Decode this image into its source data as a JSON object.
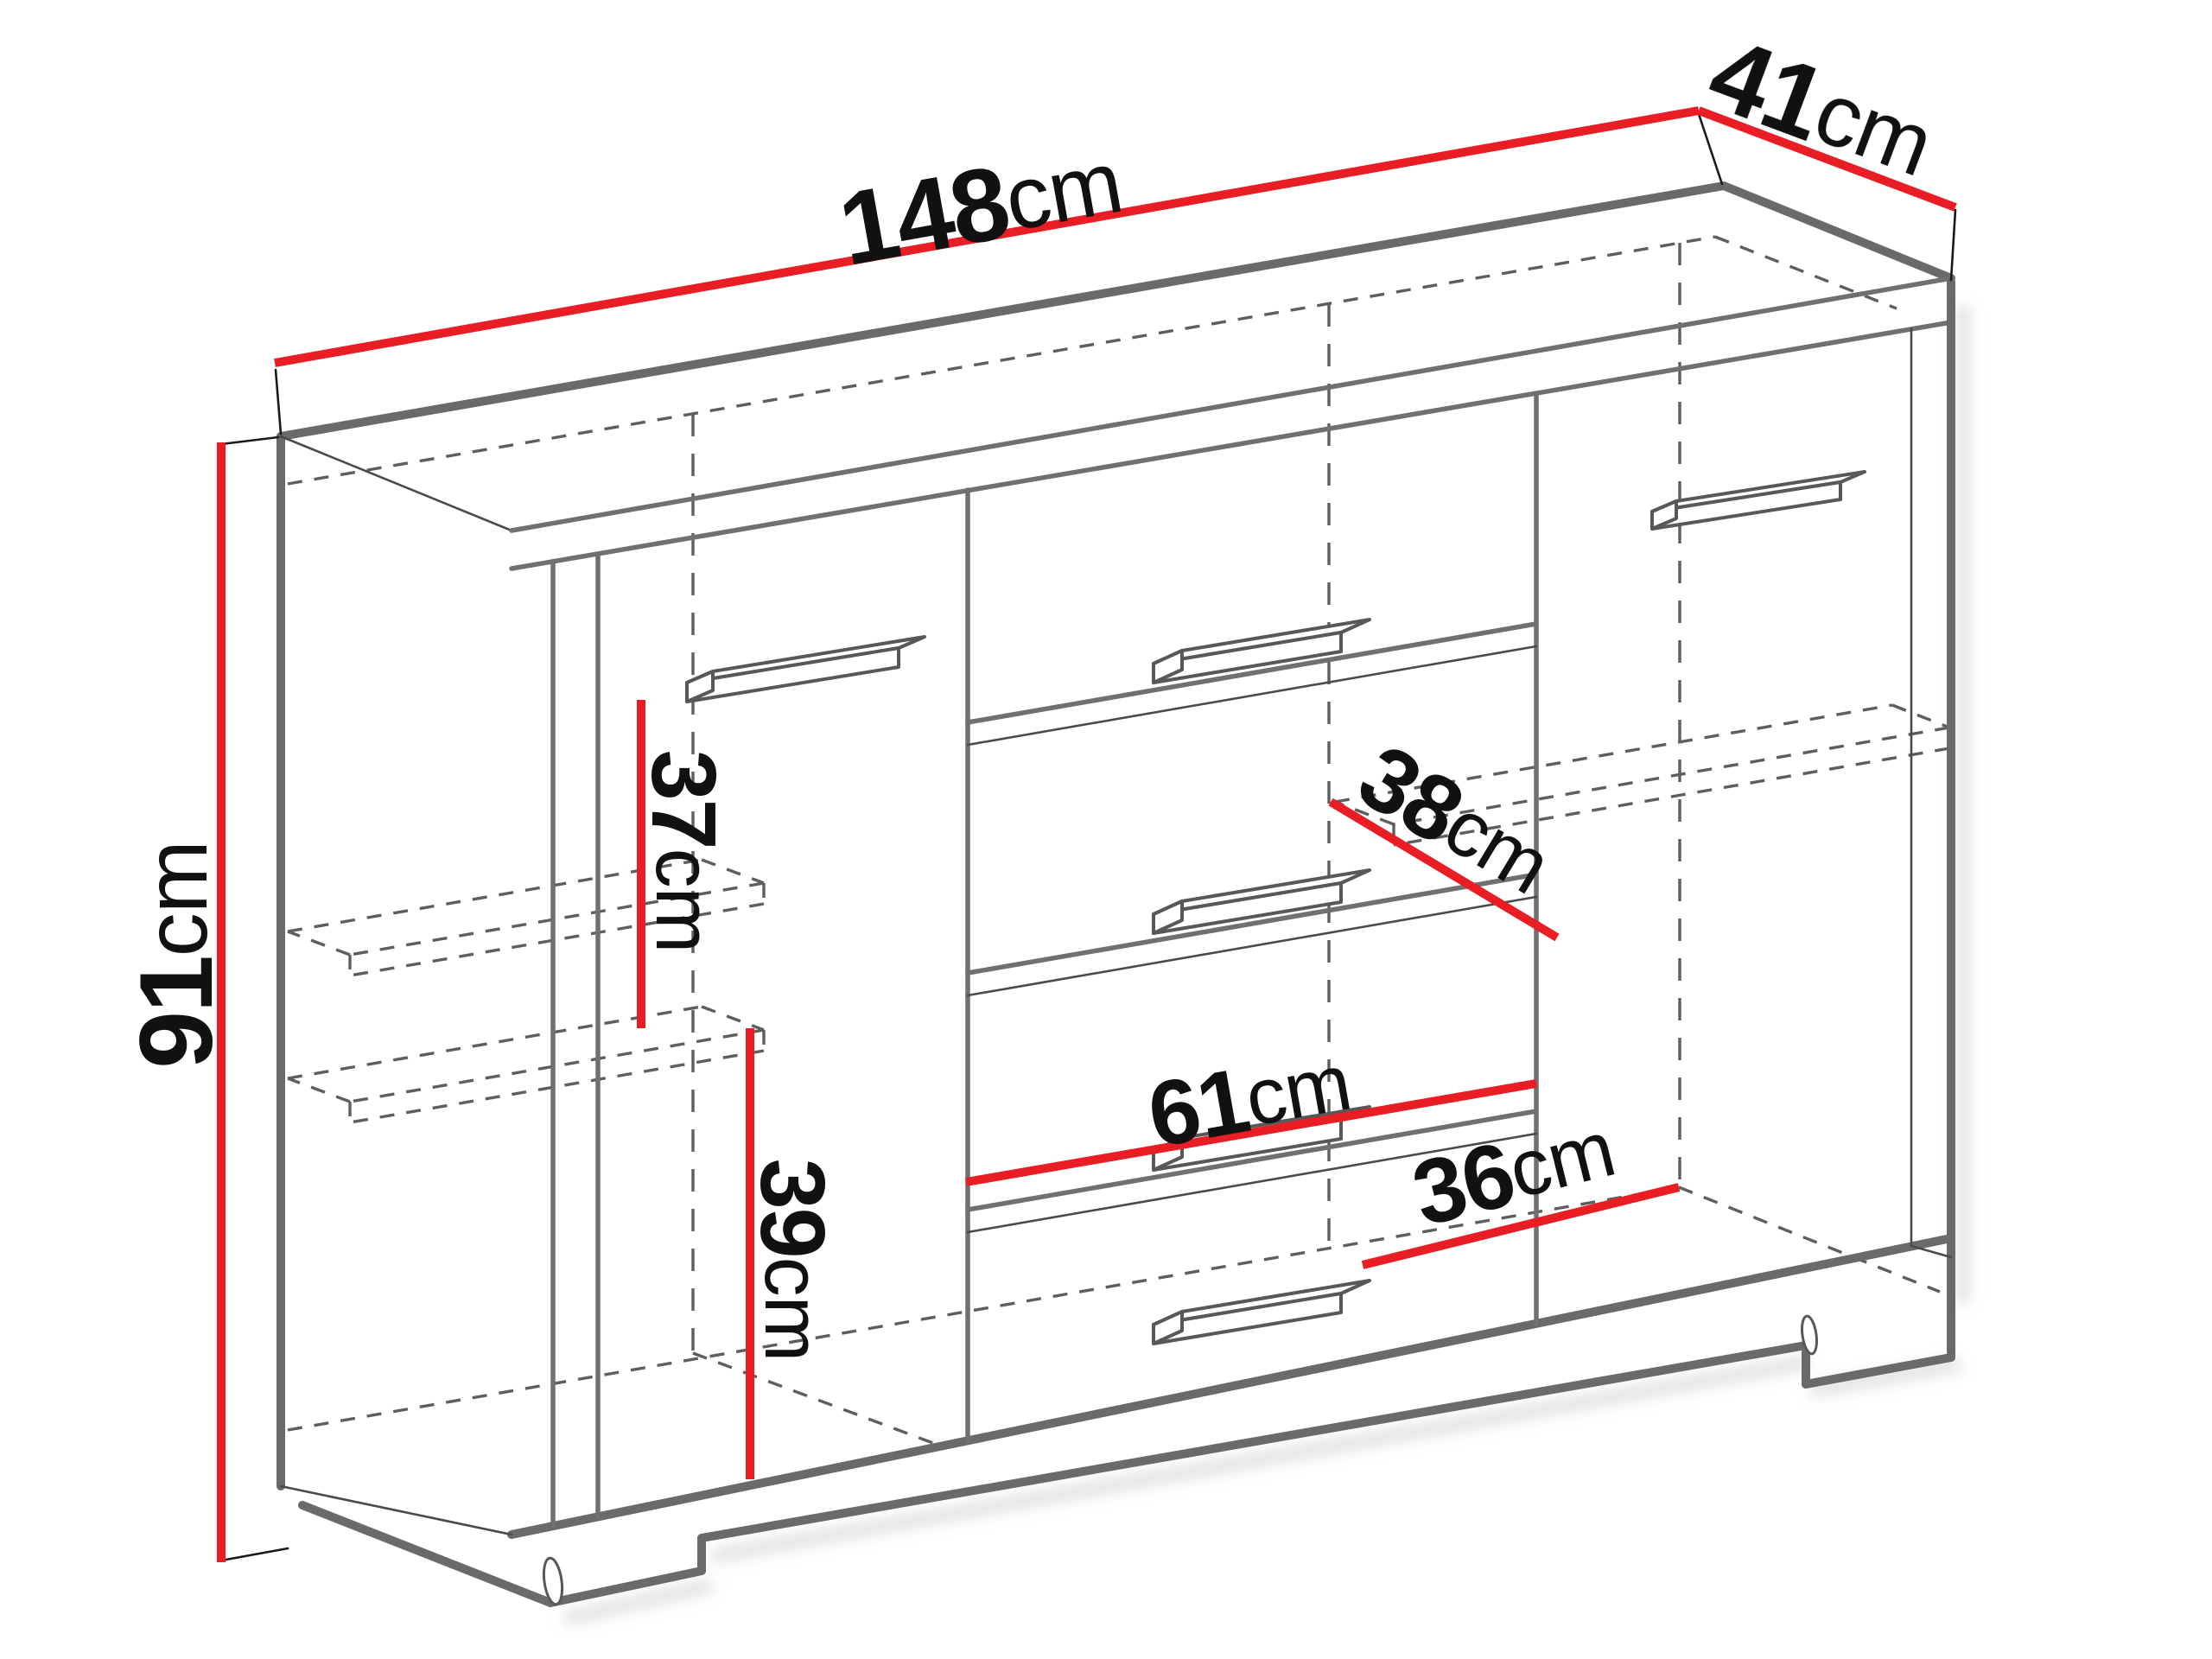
{
  "diagram": {
    "type": "furniture dimension drawing",
    "subject": "sideboard cabinet with two doors and four drawers",
    "accent_color": "#e81e24",
    "outline_color": "#6a6a6a",
    "hidden_line_color": "#5e5e5e",
    "text_color": "#111111",
    "background_color": "#ffffff",
    "dimensions": {
      "width": {
        "value": "148",
        "unit": "cm"
      },
      "depth": {
        "value": "41",
        "unit": "cm"
      },
      "height": {
        "value": "91",
        "unit": "cm"
      },
      "left_upper_shelf_gap": {
        "value": "37",
        "unit": "cm"
      },
      "left_lower_shelf_gap": {
        "value": "39",
        "unit": "cm"
      },
      "inner_shelf_depth": {
        "value": "38",
        "unit": "cm"
      },
      "drawer_inner_width": {
        "value": "61",
        "unit": "cm"
      },
      "right_inner_width": {
        "value": "36",
        "unit": "cm"
      }
    }
  }
}
